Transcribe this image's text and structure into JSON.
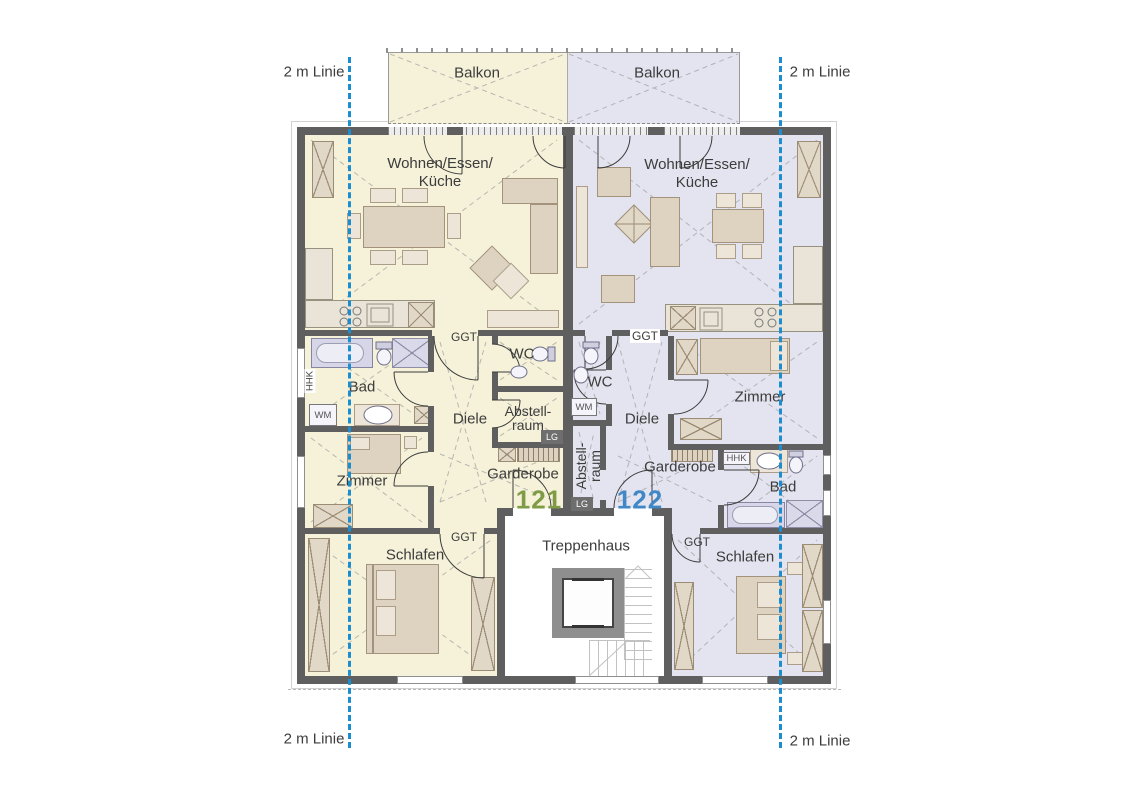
{
  "guide": {
    "label": "2 m Linie"
  },
  "balcony": {
    "left_label": "Balkon",
    "right_label": "Balkon"
  },
  "stairwell": {
    "label": "Treppenhaus"
  },
  "tags": {
    "ggt": "GGT",
    "lg": "LG",
    "wm": "WM",
    "hhk": "HHK"
  },
  "apt121": {
    "number": "121",
    "living_line1": "Wohnen/Essen/",
    "living_line2": "Küche",
    "bad": "Bad",
    "wc": "WC",
    "diele": "Diele",
    "abstell_line1": "Abstell-",
    "abstell_line2": "raum",
    "garderobe": "Garderobe",
    "zimmer": "Zimmer",
    "schlafen": "Schlafen"
  },
  "apt122": {
    "number": "122",
    "living_line1": "Wohnen/Essen/",
    "living_line2": "Küche",
    "bad": "Bad",
    "wc": "WC",
    "diele": "Diele",
    "abstell_line1": "Abstell-",
    "abstell_line2": "raum",
    "garderobe": "Garderobe",
    "zimmer": "Zimmer",
    "schlafen": "Schlafen"
  },
  "colors": {
    "apartment_121_fill": "#f5f2d9",
    "apartment_122_fill": "#e4e4f0",
    "guide_line_blue": "#1c8dce",
    "number_121_green": "#7f9b45",
    "number_122_blue": "#3f87c5",
    "wall_gray": "#5f5f5f"
  }
}
